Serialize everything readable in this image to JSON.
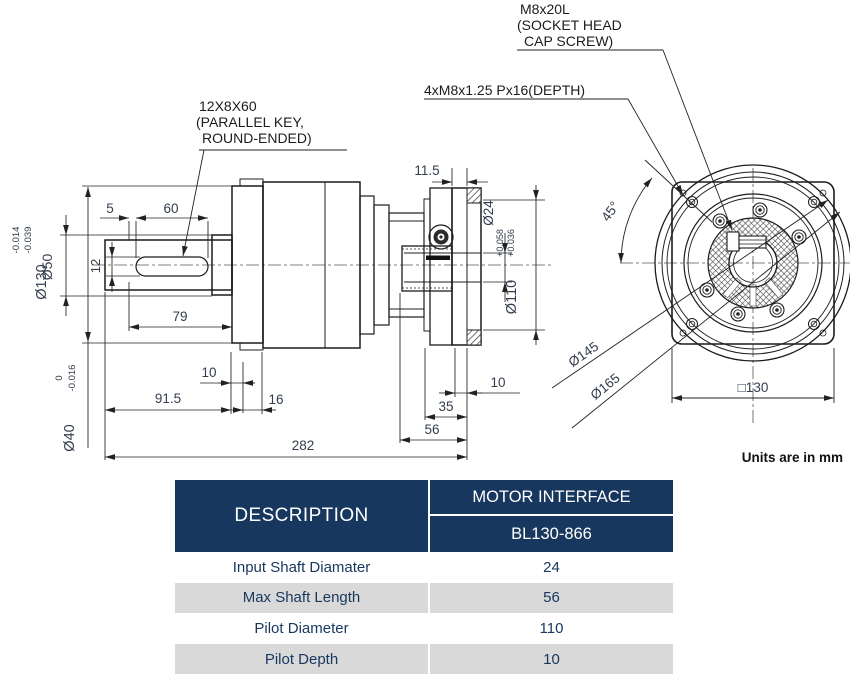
{
  "drawing": {
    "units_note": "Units are in mm",
    "callouts": {
      "key1": "12X8X60",
      "key2": "(PARALLEL KEY,",
      "key3": "ROUND-ENDED)",
      "screw1": "M8x20L",
      "screw2": "(SOCKET HEAD",
      "screw3": "CAP SCREW)",
      "tap": "4xM8x1.25 Px16(DEPTH)"
    },
    "side": {
      "d5": "5",
      "d60": "60",
      "d12": "12",
      "d79": "79",
      "d10a": "10",
      "d91_5": "91.5",
      "d16": "16",
      "d282": "282",
      "d11_5": "11.5",
      "d10b": "10",
      "d35": "35",
      "d56": "56",
      "dia130": "Ø130",
      "dia130u": "-0.014",
      "dia130l": "-0.039",
      "dia50": "Ø50",
      "dia40": "Ø40",
      "dia40u": "0",
      "dia40l": "-0.016",
      "dia24": "Ø24",
      "dia110": "Ø110",
      "dia110u": "+0.058",
      "dia110l": "+0.036"
    },
    "front": {
      "a45": "45°",
      "dia145": "Ø145",
      "dia165": "Ø165",
      "sq130": "□130"
    }
  },
  "table": {
    "description_header": "DESCRIPTION",
    "interface_header": "MOTOR INTERFACE",
    "model": "BL130-866",
    "rows": [
      {
        "label": "Input Shaft Diamater",
        "value": "24"
      },
      {
        "label": "Max Shaft Length",
        "value": "56"
      },
      {
        "label": "Pilot Diameter",
        "value": "110"
      },
      {
        "label": "Pilot Depth",
        "value": "10"
      }
    ],
    "colors": {
      "header_bg": "#17375e",
      "alt_row_bg": "#d9d9d9",
      "text": "#17375e"
    }
  }
}
